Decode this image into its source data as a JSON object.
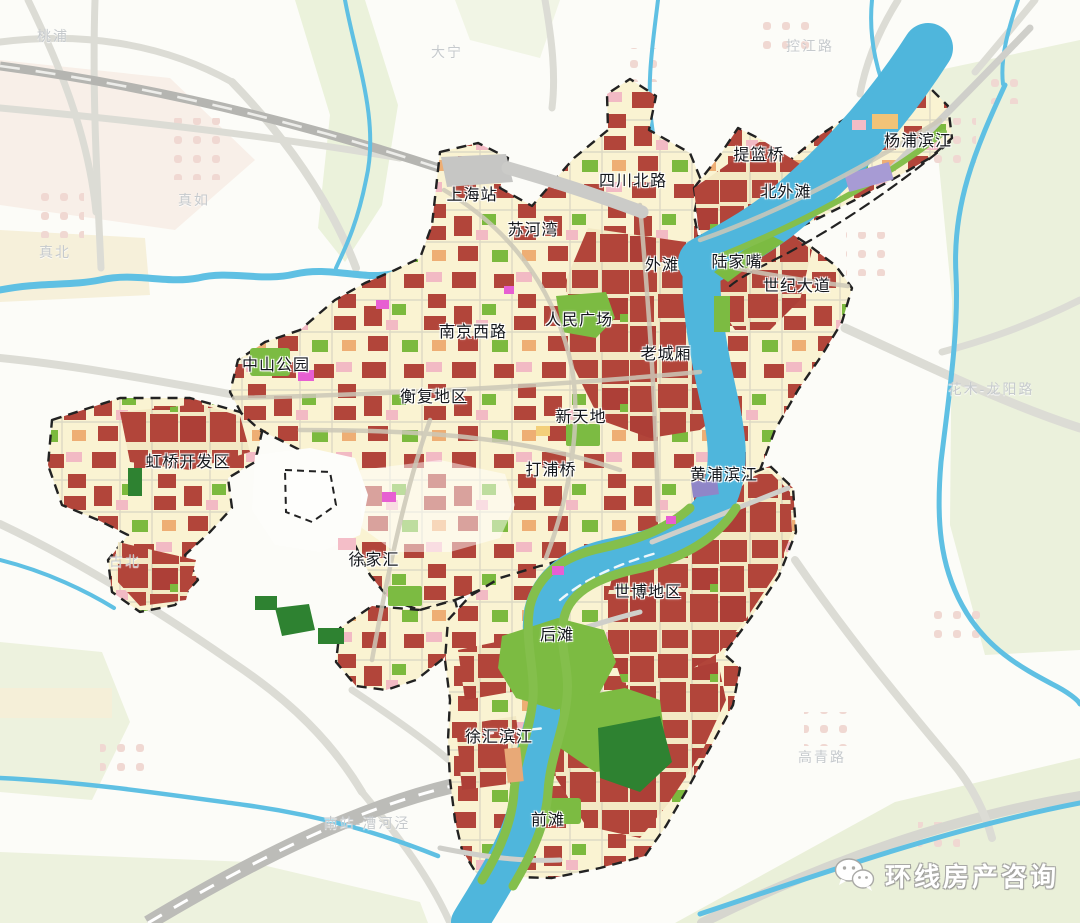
{
  "map": {
    "district_labels": [
      {
        "text": "上海站",
        "x": 472,
        "y": 196
      },
      {
        "text": "苏河湾",
        "x": 533,
        "y": 231
      },
      {
        "text": "四川北路",
        "x": 633,
        "y": 182
      },
      {
        "text": "提篮桥",
        "x": 759,
        "y": 156
      },
      {
        "text": "北外滩",
        "x": 786,
        "y": 193
      },
      {
        "text": "杨浦滨江",
        "x": 918,
        "y": 142
      },
      {
        "text": "外滩",
        "x": 662,
        "y": 266
      },
      {
        "text": "陆家嘴",
        "x": 737,
        "y": 263
      },
      {
        "text": "世纪大道",
        "x": 797,
        "y": 287
      },
      {
        "text": "人民广场",
        "x": 579,
        "y": 321
      },
      {
        "text": "南京西路",
        "x": 473,
        "y": 333
      },
      {
        "text": "老城厢",
        "x": 666,
        "y": 355
      },
      {
        "text": "中山公园",
        "x": 276,
        "y": 366
      },
      {
        "text": "衡复地区",
        "x": 434,
        "y": 398
      },
      {
        "text": "新天地",
        "x": 581,
        "y": 418
      },
      {
        "text": "虹桥开发区",
        "x": 188,
        "y": 463
      },
      {
        "text": "打浦桥",
        "x": 551,
        "y": 471
      },
      {
        "text": "黄浦滨江",
        "x": 724,
        "y": 476
      },
      {
        "text": "徐家汇",
        "x": 374,
        "y": 561
      },
      {
        "text": "世博地区",
        "x": 648,
        "y": 593
      },
      {
        "text": "后滩",
        "x": 557,
        "y": 636
      },
      {
        "text": "徐汇滨江",
        "x": 499,
        "y": 738
      },
      {
        "text": "前滩",
        "x": 548,
        "y": 821
      }
    ],
    "context_labels": [
      {
        "text": "桃浦",
        "x": 53,
        "y": 36
      },
      {
        "text": "大宁",
        "x": 447,
        "y": 52
      },
      {
        "text": "控江路",
        "x": 810,
        "y": 46
      },
      {
        "text": "真如",
        "x": 194,
        "y": 200
      },
      {
        "text": "真北",
        "x": 55,
        "y": 252
      },
      {
        "text": "古北",
        "x": 125,
        "y": 561
      },
      {
        "text": "花木-龙阳路",
        "x": 991,
        "y": 389
      },
      {
        "text": "高青路",
        "x": 822,
        "y": 757
      },
      {
        "text": "南站-漕河泾",
        "x": 367,
        "y": 823
      }
    ],
    "watermark": {
      "text": "环线房产咨询",
      "icon": "wechat-icon"
    },
    "colors": {
      "boundary_dash": "#222222",
      "block_red": "#b2453a",
      "block_cream": "#faf3d2",
      "park_green": "#7cbb42",
      "dark_green": "#2e8231",
      "river_blue": "#4fb6dc",
      "canal_blue": "#5fc0e3",
      "pink": "#f2bac4",
      "orange": "#eeae74",
      "magenta": "#e75fd2",
      "purple": "#a79bd4",
      "road_gray": "#dcdcd5",
      "rail_gray": "#b5b5b1"
    }
  }
}
